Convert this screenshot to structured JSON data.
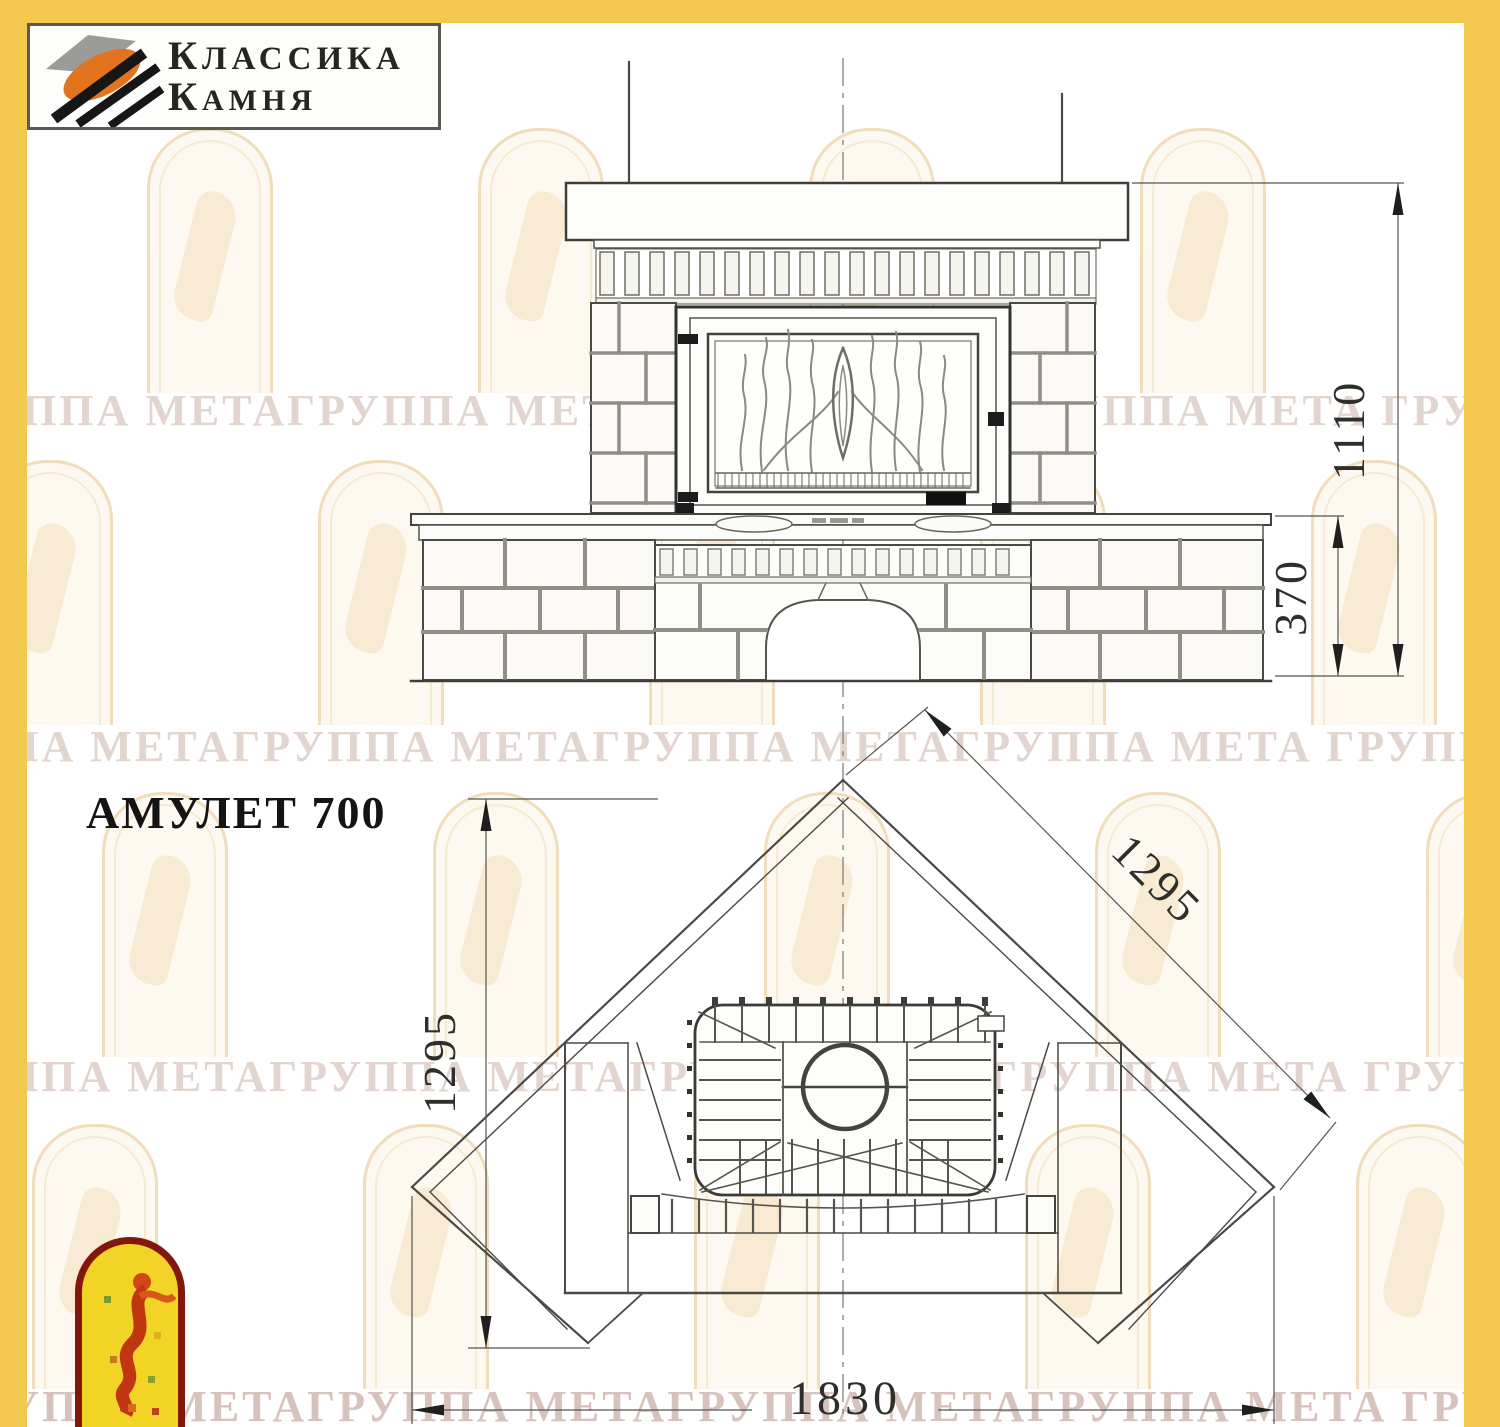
{
  "page": {
    "border_color": "#f2c84e"
  },
  "logo": {
    "line1": "КЛАССИКА",
    "line2": "КАМНЯ"
  },
  "title": "АМУЛЕТ 700",
  "watermark": {
    "text": "ГРУППА МЕТАГРУППА МЕТАГРУППА МЕТАГРУППА МЕТА"
  },
  "drawing": {
    "front_view": {
      "dim_total_height": "1110",
      "dim_bench_height": "370"
    },
    "plan_view": {
      "dim_left_depth": "1295",
      "dim_right_depth": "1295",
      "dim_front_width": "1830"
    }
  }
}
